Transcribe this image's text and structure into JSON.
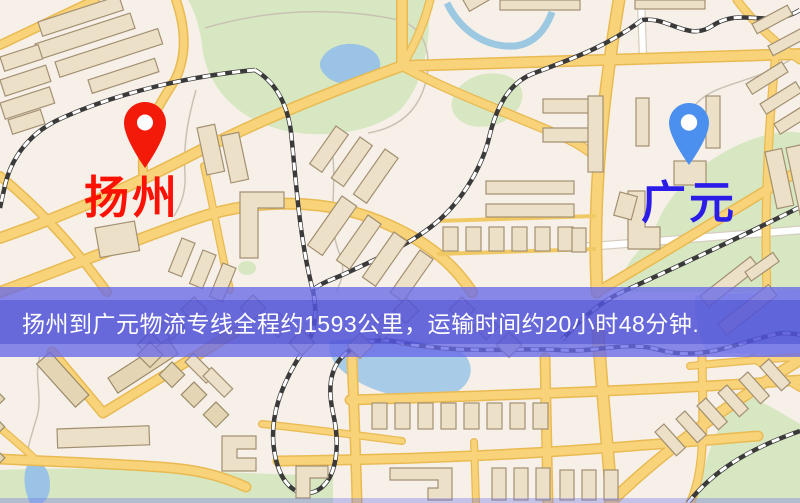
{
  "map": {
    "markers": {
      "origin": {
        "label": "扬州",
        "pin_color": "#f41a0a",
        "label_color": "#fb1205"
      },
      "destination": {
        "label": "广元",
        "pin_color": "#4b90ee",
        "label_color": "#2b1ce8"
      }
    }
  },
  "banner": {
    "text": "扬州到广元物流专线全程约1593公里，运输时间约20小时48分钟.",
    "route_origin": "扬州",
    "route_destination": "广元",
    "distance": "约1593公里",
    "duration": "约20小时48分钟",
    "background": "#6869e8",
    "text_color": "#ffffff"
  },
  "map_palette": {
    "land": "#f7f0e8",
    "road_fill": "#f8d37a",
    "road_casing": "#e9ba52",
    "white_road": "#ffffff",
    "park": "#d7e7c1",
    "water": "#9ac3e6",
    "railway": "#3a3a3a",
    "building": "#ece1c8",
    "building_outline": "#a39072"
  }
}
